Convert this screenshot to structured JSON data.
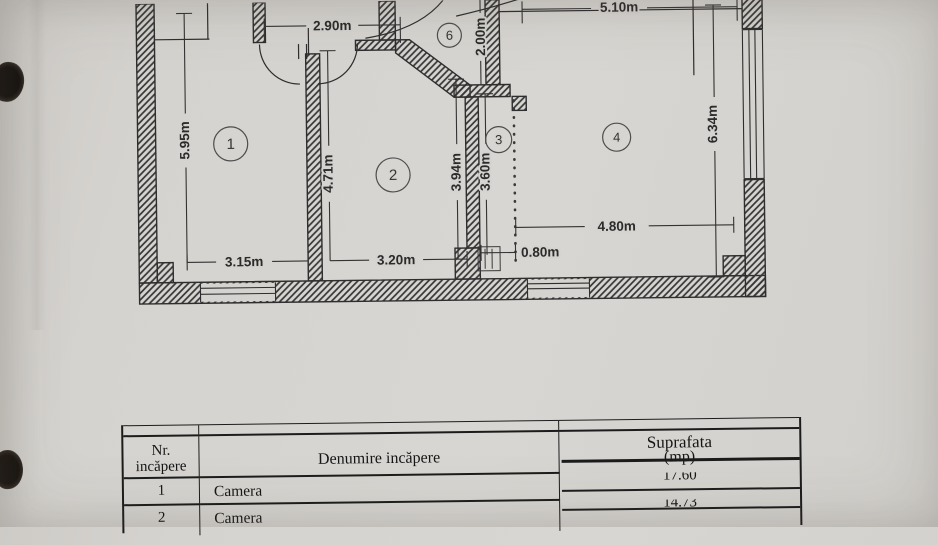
{
  "floor_plan": {
    "rooms": [
      {
        "number": "1"
      },
      {
        "number": "2"
      },
      {
        "number": "3"
      },
      {
        "number": "4"
      },
      {
        "number": "6"
      }
    ],
    "dimensions": {
      "hall_width_top": "2.90m",
      "room4_width_top": "5.10m",
      "entry_depth": "2.00m",
      "room1_height": "5.95m",
      "room1_width": "3.15m",
      "room2_height": "4.71m",
      "room2_width": "3.20m",
      "corridor_height_left": "3.94m",
      "corridor_height_right": "3.60m",
      "corridor_width": "0.80m",
      "room4_width": "4.80m",
      "room4_height": "6.34m"
    }
  },
  "area_table": {
    "header": {
      "col1_line1": "Nr.",
      "col1_line2": "incăpere",
      "col2": "Denumire incăpere",
      "col3_line1": "Suprafata",
      "col3_line2": "(mp)"
    },
    "rows": [
      {
        "nr": "1",
        "name": "Camera",
        "area": "17.60"
      },
      {
        "nr": "2",
        "name": "Camera",
        "area": "14.73"
      }
    ]
  },
  "colors": {
    "paper": "#d5d3cf",
    "ink": "#2e2e2e",
    "table_line": "#1c1c1c"
  }
}
